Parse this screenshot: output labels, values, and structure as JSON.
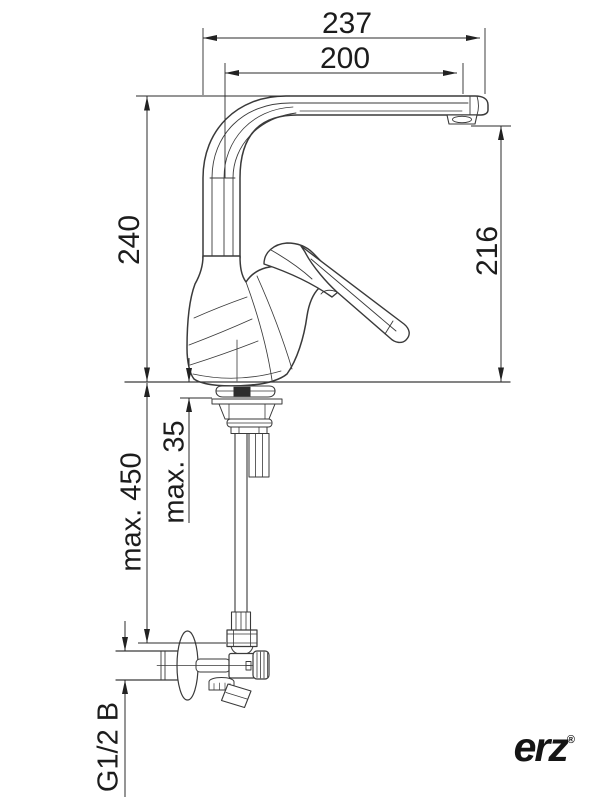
{
  "drawing": {
    "type": "technical-dimension-drawing",
    "subject": "Single-lever kitchen mixer tap with high swivel spout, mounting hardware and angle valve, side elevation",
    "units": "mm",
    "dimensions": [
      {
        "id": "total-spout-projection",
        "label": "237",
        "orientation": "horizontal"
      },
      {
        "id": "projection-to-aerator",
        "label": "200",
        "orientation": "horizontal"
      },
      {
        "id": "height-spout-top",
        "label": "240",
        "orientation": "vertical"
      },
      {
        "id": "height-aerator-outlet",
        "label": "216",
        "orientation": "vertical"
      },
      {
        "id": "max-hose-length",
        "label": "max. 450",
        "orientation": "vertical"
      },
      {
        "id": "max-deck-thickness",
        "label": "max. 35",
        "orientation": "vertical"
      },
      {
        "id": "connection-thread",
        "label": "G1/2 B",
        "orientation": "vertical"
      }
    ],
    "brand": {
      "logo_text": "erz",
      "registered_mark": "®"
    },
    "colors": {
      "line": "#2b2b2b",
      "text": "#1c1c1c",
      "background": "#ffffff",
      "fill_band": "#2d2d2d"
    }
  }
}
